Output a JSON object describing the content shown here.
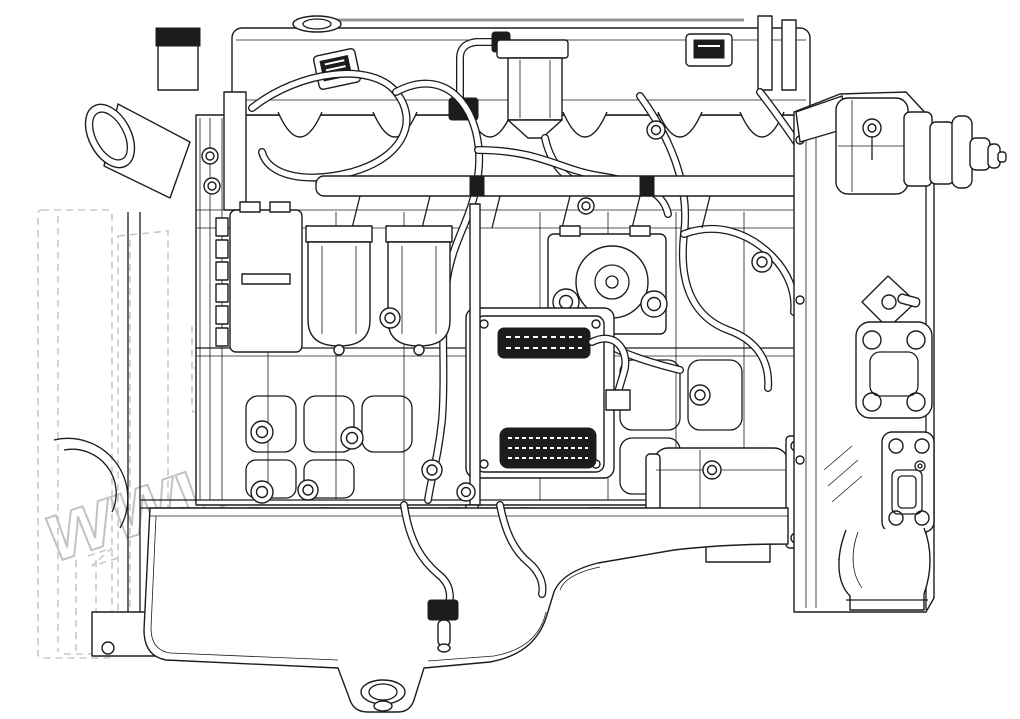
{
  "page": {
    "width": 1020,
    "height": 719
  },
  "colors": {
    "page": "#ffffff",
    "ink": "#1c1c1c",
    "edge": "#949494",
    "ghost": "#c9c9c9",
    "watermark": "#c2c2c2"
  },
  "watermark": {
    "text": "www.simtruck.biz",
    "angle_deg": -18.5
  },
  "diagram": {
    "type": "engine-parts-line-drawing",
    "view": "left-side-elevation",
    "parts": [
      "valve-cover",
      "oil-filler-cap",
      "crankcase-breather",
      "harness-loom",
      "intake-water-horn",
      "front-mount",
      "alternator",
      "fuel-filter-1",
      "fuel-filter-2",
      "fuel-rail",
      "high-pressure-pump",
      "ecu-module",
      "engine-block",
      "starter-motor",
      "oil-pan",
      "drain-plug",
      "dipstick",
      "flywheel-housing",
      "exhaust-flange",
      "air-compressor-pump",
      "ghost-bracket-phantom"
    ]
  }
}
